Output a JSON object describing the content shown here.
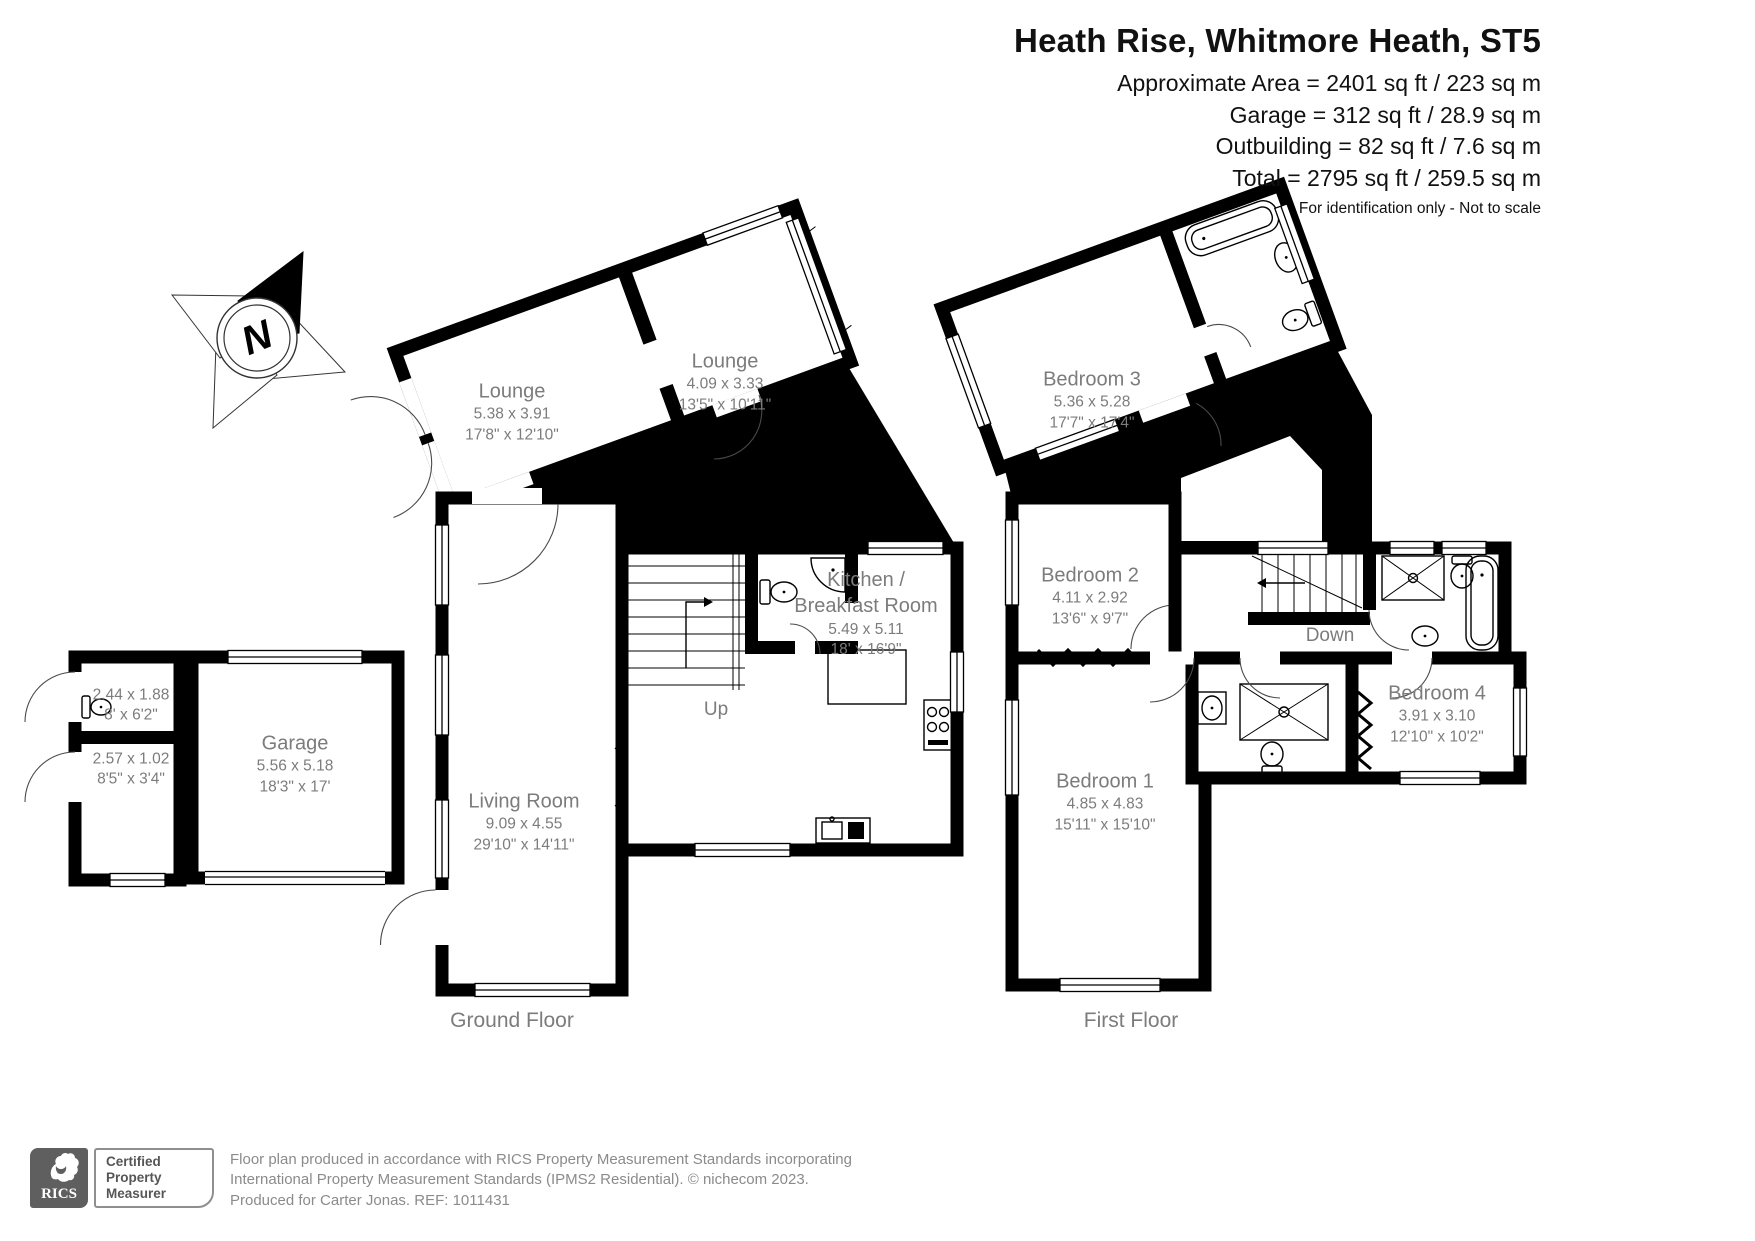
{
  "header": {
    "title": "Heath Rise, Whitmore Heath, ST5",
    "line1": "Approximate Area = 2401 sq ft / 223 sq m",
    "line2": "Garage = 312 sq ft / 28.9 sq m",
    "line3": "Outbuilding = 82 sq ft / 7.6 sq m",
    "line4": "Total = 2795 sq ft / 259.5 sq m",
    "disclaimer": "For identification only - Not to scale"
  },
  "compass": {
    "north_label": "N"
  },
  "ground_floor": {
    "floor_label": "Ground Floor",
    "stairs_label": "Up",
    "rooms": {
      "lounge_rear": {
        "name": "Lounge",
        "metric": "5.38 x 3.91",
        "imperial": "17'8\" x 12'10\""
      },
      "lounge_front": {
        "name": "Lounge",
        "metric": "4.09 x 3.33",
        "imperial": "13'5\" x 10'11\""
      },
      "living_room": {
        "name": "Living Room",
        "metric": "9.09 x 4.55",
        "imperial": "29'10\" x 14'11\""
      },
      "kitchen": {
        "name_line1": "Kitchen /",
        "name_line2": "Breakfast Room",
        "metric": "5.49 x 5.11",
        "imperial": "18' x 16'9\""
      },
      "garage": {
        "name": "Garage",
        "metric": "5.56 x 5.18",
        "imperial": "18'3\" x 17'"
      },
      "outbuilding_room_1": {
        "metric": "2.44 x 1.88",
        "imperial": "8' x 6'2\""
      },
      "outbuilding_room_2": {
        "metric": "2.57 x 1.02",
        "imperial": "8'5\" x 3'4\""
      }
    }
  },
  "first_floor": {
    "floor_label": "First Floor",
    "stairs_label": "Down",
    "rooms": {
      "bedroom_1": {
        "name": "Bedroom 1",
        "metric": "4.85 x 4.83",
        "imperial": "15'11\" x 15'10\""
      },
      "bedroom_2": {
        "name": "Bedroom 2",
        "metric": "4.11 x 2.92",
        "imperial": "13'6\" x 9'7\""
      },
      "bedroom_3": {
        "name": "Bedroom 3",
        "metric": "5.36 x 5.28",
        "imperial": "17'7\" x 17'4\""
      },
      "bedroom_4": {
        "name": "Bedroom 4",
        "metric": "3.91 x 3.10",
        "imperial": "12'10\" x 10'2\""
      }
    }
  },
  "footer": {
    "rics_wordmark": "RICS",
    "badge_line1": "Certified",
    "badge_line2": "Property",
    "badge_line3": "Measurer",
    "text_line1": "Floor plan produced in accordance with RICS Property Measurement Standards incorporating",
    "text_line2": "International Property Measurement Standards (IPMS2 Residential).   © nichecom 2023.",
    "text_line3": "Produced for Carter Jonas.   REF:  1011431"
  }
}
